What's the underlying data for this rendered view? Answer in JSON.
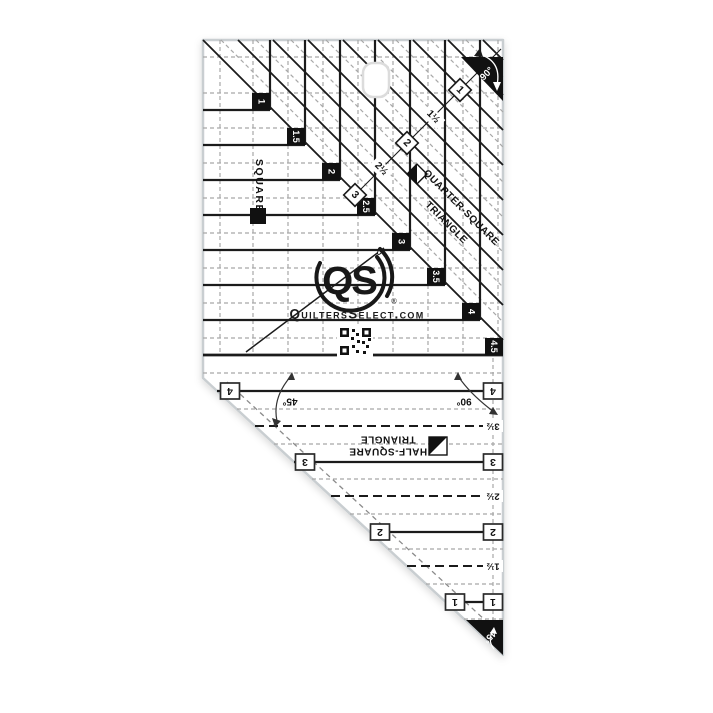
{
  "ruler": {
    "brand": {
      "logo": "QS",
      "registered_symbol": "®",
      "website": "QuiltersSelect.com"
    },
    "quarter_square": {
      "title_line1": "QUARTER-SQUARE",
      "title_line2": "TRIANGLE",
      "square_label": "SQUARE",
      "corner_angle": "90°",
      "step_sizes": [
        "1",
        "1.5",
        "2",
        "2.5",
        "3",
        "3.5",
        "4",
        "4.5"
      ],
      "diamond_sizes": [
        "1",
        "2",
        "3"
      ],
      "half_sizes": [
        "1½",
        "2½"
      ]
    },
    "half_square": {
      "title_line1": "HALF-SQUARE",
      "title_line2": "TRIANGLE",
      "corner_angle": "45°",
      "left_angle": "45°",
      "right_angle": "90°",
      "line_sizes": [
        "4",
        "3",
        "2",
        "1"
      ],
      "half_sizes": [
        "3½",
        "2½",
        "1½"
      ]
    },
    "colors": {
      "ink": "#1b1b1b",
      "grid_dash": "#a8a8a8",
      "edge": "#c9ced1"
    }
  }
}
